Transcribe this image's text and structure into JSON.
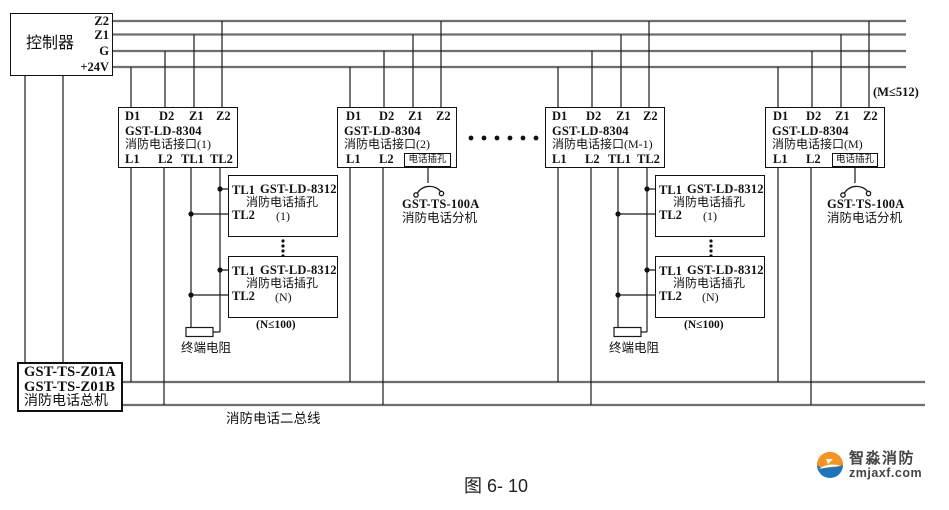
{
  "controller": {
    "label": "控制器",
    "terminals": [
      "Z2",
      "Z1",
      "G",
      "+24V"
    ]
  },
  "max_note": "(M≤512)",
  "interfaces": [
    {
      "top": [
        "D1",
        "D2",
        "Z1",
        "Z2"
      ],
      "model": "GST-LD-8304",
      "name": "消防电话接口(1)",
      "bottom": [
        "L1",
        "L2",
        "TL1",
        "TL2"
      ]
    },
    {
      "top": [
        "D1",
        "D2",
        "Z1",
        "Z2"
      ],
      "model": "GST-LD-8304",
      "name": "消防电话接口(2)",
      "bottom": [
        "L1",
        "L2"
      ],
      "jack": "电话插孔"
    },
    {
      "top": [
        "D1",
        "D2",
        "Z1",
        "Z2"
      ],
      "model": "GST-LD-8304",
      "name": "消防电话接口(M-1)",
      "bottom": [
        "L1",
        "L2",
        "TL1",
        "TL2"
      ]
    },
    {
      "top": [
        "D1",
        "D2",
        "Z1",
        "Z2"
      ],
      "model": "GST-LD-8304",
      "name": "消防电话接口(M)",
      "bottom": [
        "L1",
        "L2"
      ],
      "jack": "电话插孔"
    }
  ],
  "phone_jacks": [
    {
      "tl1": "TL1",
      "tl2": "TL2",
      "model": "GST-LD-8312",
      "name": "消防电话插孔",
      "index": "(1)"
    },
    {
      "tl1": "TL1",
      "tl2": "TL2",
      "model": "GST-LD-8312",
      "name": "消防电话插孔",
      "index": "(N)"
    }
  ],
  "notes": {
    "jack_limit": "(N≤100)",
    "resistor": "终端电阻"
  },
  "extension": {
    "model": "GST-TS-100A",
    "name": "消防电话分机"
  },
  "master": {
    "line1": "GST-TS-Z01A",
    "line2": "GST-TS-Z01B",
    "line3": "消防电话总机"
  },
  "bus_label": "消防电话二总线",
  "caption": "图 6- 10",
  "logo": {
    "name": "智淼消防",
    "site": "zmjaxf.com",
    "orange": "#F7941E",
    "blue": "#1C75BC"
  }
}
